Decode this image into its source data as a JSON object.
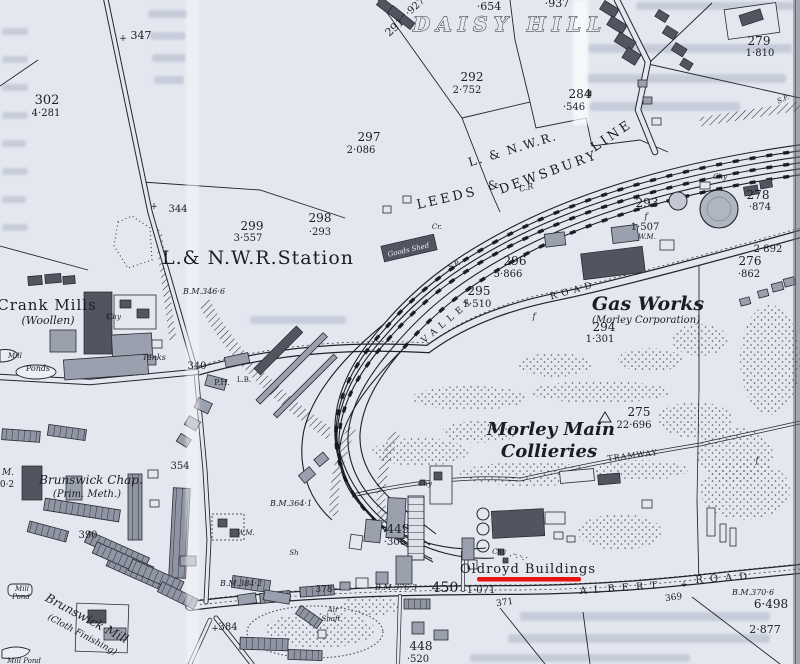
{
  "map": {
    "type": "historical ordnance survey extract",
    "colors": {
      "paper": "#e4e7ef",
      "ink": "#1b1d26",
      "building_dark": "#51555f",
      "building_gray": "#9aa0ad",
      "underline_red": "#e8150f"
    },
    "annotation": {
      "highlighted_label": "Oldroyd Buildings",
      "style": "red-underline",
      "color": "#e8150f"
    },
    "labels": [
      {
        "t": "+",
        "x": 123,
        "y": 41,
        "s": 9,
        "c": "plot"
      },
      {
        "t": "347",
        "x": 141,
        "y": 39,
        "s": 11,
        "c": "plot"
      },
      {
        "t": "302",
        "x": 47,
        "y": 104,
        "s": 13,
        "c": "plot"
      },
      {
        "t": "4·281",
        "x": 46,
        "y": 116,
        "s": 10,
        "c": "area"
      },
      {
        "t": "291",
        "x": 397,
        "y": 30,
        "s": 11,
        "c": "plot",
        "r": -42
      },
      {
        "t": "·927",
        "x": 417,
        "y": 9,
        "s": 10,
        "c": "area",
        "r": -42
      },
      {
        "t": "·654",
        "x": 489,
        "y": 10,
        "s": 11,
        "c": "area"
      },
      {
        "t": "·937",
        "x": 557,
        "y": 7,
        "s": 11,
        "c": "area"
      },
      {
        "t": "DAISY HILL",
        "x": 510,
        "y": 31,
        "s": 20,
        "c": "place",
        "sp": 6
      },
      {
        "t": "279",
        "x": 759,
        "y": 45,
        "s": 12,
        "c": "plot"
      },
      {
        "t": "1·810",
        "x": 760,
        "y": 56,
        "s": 10,
        "c": "area"
      },
      {
        "t": "S.P.",
        "x": 784,
        "y": 101,
        "s": 7,
        "c": "smit",
        "r": -25
      },
      {
        "t": "292",
        "x": 472,
        "y": 81,
        "s": 12,
        "c": "plot"
      },
      {
        "t": "2·752",
        "x": 467,
        "y": 93,
        "s": 10,
        "c": "area"
      },
      {
        "t": "284",
        "x": 580,
        "y": 98,
        "s": 12,
        "c": "plot"
      },
      {
        "t": "·546",
        "x": 574,
        "y": 110,
        "s": 10,
        "c": "area"
      },
      {
        "t": "297",
        "x": 369,
        "y": 141,
        "s": 12,
        "c": "plot"
      },
      {
        "t": "2·086",
        "x": 361,
        "y": 153,
        "s": 10,
        "c": "area"
      },
      {
        "t": "L. & N.W.R.",
        "x": 514,
        "y": 153,
        "s": 12,
        "c": "railcap",
        "r": -17,
        "sp": 2
      },
      {
        "t": "LEEDS",
        "x": 448,
        "y": 202,
        "s": 13,
        "c": "railcap",
        "r": -13,
        "sp": 3
      },
      {
        "t": "&",
        "x": 494,
        "y": 189,
        "s": 12,
        "c": "railcap",
        "r": -15
      },
      {
        "t": "DEWSBURY",
        "x": 550,
        "y": 176,
        "s": 13,
        "c": "railcap",
        "r": -20,
        "sp": 3
      },
      {
        "t": "LINE",
        "x": 614,
        "y": 139,
        "s": 13,
        "c": "railcap",
        "r": -34,
        "sp": 3
      },
      {
        "t": "C.R",
        "x": 527,
        "y": 190,
        "s": 8,
        "c": "smit",
        "r": -15
      },
      {
        "t": "+",
        "x": 154,
        "y": 209,
        "s": 9,
        "c": "plot"
      },
      {
        "t": "344",
        "x": 178,
        "y": 212,
        "s": 10,
        "c": "plot"
      },
      {
        "t": "299",
        "x": 252,
        "y": 230,
        "s": 12,
        "c": "plot"
      },
      {
        "t": "3·557",
        "x": 248,
        "y": 241,
        "s": 10,
        "c": "area"
      },
      {
        "t": "298",
        "x": 320,
        "y": 222,
        "s": 12,
        "c": "plot"
      },
      {
        "t": "·293",
        "x": 320,
        "y": 235,
        "s": 10,
        "c": "area"
      },
      {
        "t": "L.& N.W.R.Station",
        "x": 258,
        "y": 264,
        "s": 19,
        "c": "bigserif"
      },
      {
        "t": "B.M.346·6",
        "x": 204,
        "y": 294,
        "s": 8,
        "c": "bm"
      },
      {
        "t": "Goods Shed",
        "x": 409,
        "y": 252,
        "s": 7,
        "c": "gshed",
        "r": -13
      },
      {
        "t": "Cr.",
        "x": 437,
        "y": 229,
        "s": 7,
        "c": "smit"
      },
      {
        "t": "S.P.",
        "x": 455,
        "y": 267,
        "s": 7,
        "c": "smit",
        "r": -25
      },
      {
        "t": "Chy",
        "x": 720,
        "y": 179,
        "s": 7,
        "c": "smit"
      },
      {
        "t": "293",
        "x": 647,
        "y": 207,
        "s": 12,
        "c": "plot"
      },
      {
        "t": "f",
        "x": 646,
        "y": 219,
        "s": 8,
        "c": "smit"
      },
      {
        "t": "1·507",
        "x": 645,
        "y": 230,
        "s": 10,
        "c": "area"
      },
      {
        "t": "W.M.",
        "x": 647,
        "y": 239,
        "s": 7,
        "c": "smit"
      },
      {
        "t": "278",
        "x": 758,
        "y": 199,
        "s": 12,
        "c": "plot"
      },
      {
        "t": "·874",
        "x": 760,
        "y": 210,
        "s": 10,
        "c": "area"
      },
      {
        "t": "2·892",
        "x": 768,
        "y": 252,
        "s": 10,
        "c": "area"
      },
      {
        "t": "276",
        "x": 750,
        "y": 265,
        "s": 12,
        "c": "plot"
      },
      {
        "t": "·862",
        "x": 749,
        "y": 277,
        "s": 10,
        "c": "area"
      },
      {
        "t": "296",
        "x": 515,
        "y": 265,
        "s": 12,
        "c": "plot"
      },
      {
        "t": "5·866",
        "x": 508,
        "y": 277,
        "s": 10,
        "c": "area"
      },
      {
        "t": "295",
        "x": 479,
        "y": 295,
        "s": 12,
        "c": "plot"
      },
      {
        "t": "1·510",
        "x": 477,
        "y": 307,
        "s": 10,
        "c": "area"
      },
      {
        "t": "VALLEY",
        "x": 450,
        "y": 322,
        "s": 9,
        "c": "roadcap",
        "r": -40,
        "sp": 5
      },
      {
        "t": "ROAD",
        "x": 574,
        "y": 293,
        "s": 9,
        "c": "roadcap",
        "r": -16,
        "sp": 5
      },
      {
        "t": "f",
        "x": 534,
        "y": 319,
        "s": 8,
        "c": "smit"
      },
      {
        "t": "Gas Works",
        "x": 648,
        "y": 310,
        "s": 19,
        "c": "bigit"
      },
      {
        "t": "(Morley Corporation)",
        "x": 646,
        "y": 323,
        "s": 10,
        "c": "medit"
      },
      {
        "t": "294",
        "x": 604,
        "y": 331,
        "s": 12,
        "c": "plot"
      },
      {
        "t": "1·301",
        "x": 600,
        "y": 342,
        "s": 10,
        "c": "area"
      },
      {
        "t": "Crank Mills",
        "x": 47,
        "y": 310,
        "s": 15,
        "c": "bigserif"
      },
      {
        "t": "(Woollen)",
        "x": 48,
        "y": 324,
        "s": 11,
        "c": "medit"
      },
      {
        "t": "Chy",
        "x": 114,
        "y": 319,
        "s": 7,
        "c": "smit"
      },
      {
        "t": "Mill",
        "x": 8,
        "y": 358,
        "s": 7,
        "c": "smit",
        "a": "start"
      },
      {
        "t": "Ponds",
        "x": 38,
        "y": 371,
        "s": 8,
        "c": "medit"
      },
      {
        "t": "Tanks",
        "x": 154,
        "y": 360,
        "s": 8,
        "c": "medit"
      },
      {
        "t": "340",
        "x": 197,
        "y": 369,
        "s": 10,
        "c": "plot"
      },
      {
        "t": "P.H.",
        "x": 222,
        "y": 385,
        "s": 8,
        "c": "plot"
      },
      {
        "t": "L.B.",
        "x": 244,
        "y": 382,
        "s": 7,
        "c": "plot"
      },
      {
        "t": "354",
        "x": 180,
        "y": 469,
        "s": 10,
        "c": "plot"
      },
      {
        "t": "275",
        "x": 639,
        "y": 416,
        "s": 12,
        "c": "plot"
      },
      {
        "t": "22·696",
        "x": 634,
        "y": 428,
        "s": 10,
        "c": "area"
      },
      {
        "t": "Morley Main",
        "x": 551,
        "y": 435,
        "s": 18,
        "c": "bigit"
      },
      {
        "t": "Collieries",
        "x": 549,
        "y": 457,
        "s": 18,
        "c": "bigit"
      },
      {
        "t": "TRAMWAY",
        "x": 633,
        "y": 458,
        "s": 8,
        "c": "roadcap",
        "r": -7,
        "sp": 1
      },
      {
        "t": "f",
        "x": 757,
        "y": 463,
        "s": 8,
        "c": "smit"
      },
      {
        "t": "B.M.364·1",
        "x": 291,
        "y": 506,
        "s": 8,
        "c": "bm"
      },
      {
        "t": "W.M.",
        "x": 246,
        "y": 535,
        "s": 7,
        "c": "smit"
      },
      {
        "t": "Sh",
        "x": 294,
        "y": 555,
        "s": 7,
        "c": "smit"
      },
      {
        "t": "449",
        "x": 398,
        "y": 533,
        "s": 12,
        "c": "plot"
      },
      {
        "t": "·306",
        "x": 395,
        "y": 545,
        "s": 10,
        "c": "area"
      },
      {
        "t": "Chy",
        "x": 425,
        "y": 486,
        "s": 7,
        "c": "smit"
      },
      {
        "t": "Chy",
        "x": 499,
        "y": 554,
        "s": 7,
        "c": "smit"
      },
      {
        "t": "Oldroyd Buildings",
        "x": 528,
        "y": 573,
        "s": 13,
        "c": "bigserif"
      },
      {
        "t": "Brunswick Chap.",
        "x": 91,
        "y": 484,
        "s": 12,
        "c": "medit"
      },
      {
        "t": "(Prim. Meth.)",
        "x": 87,
        "y": 497,
        "s": 10,
        "c": "medit"
      },
      {
        "t": "390",
        "x": 88,
        "y": 538,
        "s": 10,
        "c": "plot"
      },
      {
        "t": "M.",
        "x": 8,
        "y": 475,
        "s": 9,
        "c": "bm"
      },
      {
        "t": "0·2",
        "x": 7,
        "y": 487,
        "s": 9,
        "c": "area"
      },
      {
        "t": "378",
        "x": 324,
        "y": 592,
        "s": 9,
        "c": "plot"
      },
      {
        "t": "B.M.384·2",
        "x": 241,
        "y": 586,
        "s": 8,
        "c": "bm"
      },
      {
        "t": "B.M.376·3",
        "x": 396,
        "y": 590,
        "s": 8,
        "c": "bm"
      },
      {
        "t": "450",
        "x": 445,
        "y": 592,
        "s": 14,
        "c": "plot"
      },
      {
        "t": "1·071",
        "x": 481,
        "y": 593,
        "s": 10,
        "c": "area"
      },
      {
        "t": "371",
        "x": 505,
        "y": 605,
        "s": 9,
        "c": "plot",
        "r": -8
      },
      {
        "t": "ALBERT",
        "x": 622,
        "y": 591,
        "s": 10,
        "c": "roadcap",
        "r": -4,
        "sp": 7
      },
      {
        "t": "+",
        "x": 684,
        "y": 587,
        "s": 9,
        "c": "plot"
      },
      {
        "t": "ROAD",
        "x": 725,
        "y": 581,
        "s": 10,
        "c": "roadcap",
        "r": -4,
        "sp": 7
      },
      {
        "t": "369",
        "x": 674,
        "y": 600,
        "s": 9,
        "c": "plot",
        "r": -8
      },
      {
        "t": "B.M.370·6",
        "x": 753,
        "y": 595,
        "s": 8,
        "c": "bm"
      },
      {
        "t": "6·498",
        "x": 771,
        "y": 608,
        "s": 12,
        "c": "area"
      },
      {
        "t": "2·877",
        "x": 765,
        "y": 633,
        "s": 11,
        "c": "area"
      },
      {
        "t": "448",
        "x": 421,
        "y": 650,
        "s": 12,
        "c": "plot"
      },
      {
        "t": "·520",
        "x": 418,
        "y": 662,
        "s": 10,
        "c": "area"
      },
      {
        "t": "+",
        "x": 215,
        "y": 631,
        "s": 9,
        "c": "plot"
      },
      {
        "t": "384",
        "x": 228,
        "y": 630,
        "s": 10,
        "c": "plot"
      },
      {
        "t": "Air",
        "x": 333,
        "y": 612,
        "s": 7,
        "c": "smit"
      },
      {
        "t": "Shaft",
        "x": 331,
        "y": 621,
        "s": 7,
        "c": "smit"
      },
      {
        "t": "Brunswick Mill",
        "x": 85,
        "y": 622,
        "s": 12,
        "c": "medit",
        "r": 28
      },
      {
        "t": "(Cloth Finishing)",
        "x": 81,
        "y": 637,
        "s": 9,
        "c": "medit",
        "r": 28
      },
      {
        "t": "Mill",
        "x": 22,
        "y": 591,
        "s": 7,
        "c": "smit"
      },
      {
        "t": "Pond",
        "x": 21,
        "y": 599,
        "s": 7,
        "c": "smit"
      },
      {
        "t": "Mill Pond",
        "x": 24,
        "y": 663,
        "s": 7,
        "c": "smit"
      }
    ]
  }
}
